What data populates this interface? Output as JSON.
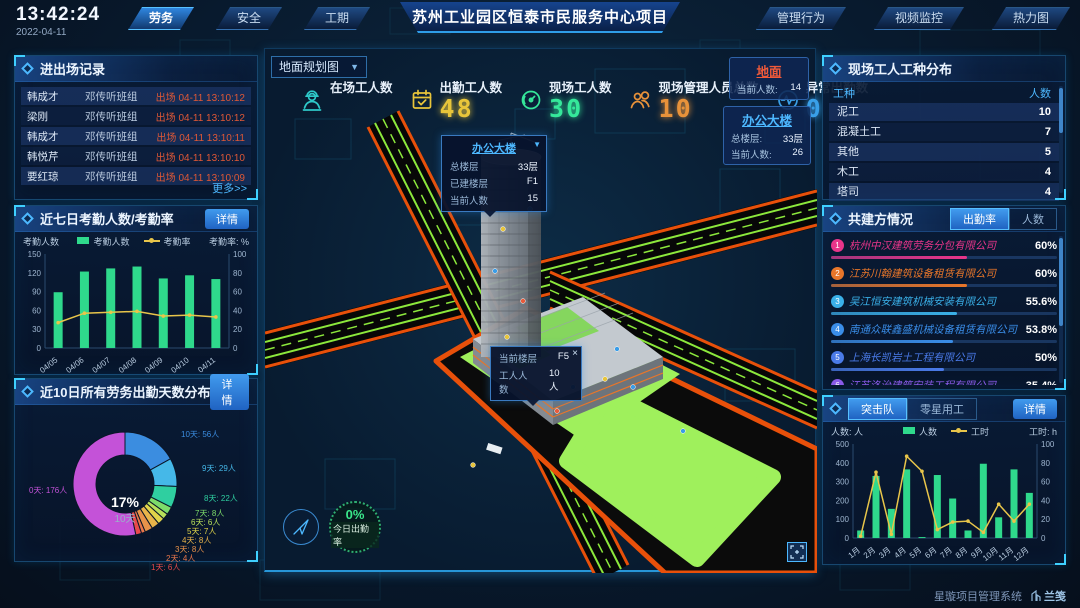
{
  "header": {
    "time": "13:42:24",
    "date": "2022-04-11",
    "left_tabs": [
      {
        "label": "劳务",
        "active": true
      },
      {
        "label": "安全",
        "active": false
      },
      {
        "label": "工期",
        "active": false
      }
    ],
    "title": "苏州工业园区恒泰市民服务中心项目",
    "right_tabs": [
      {
        "label": "管理行为",
        "active": false
      },
      {
        "label": "视频监控",
        "active": false
      },
      {
        "label": "热力图",
        "active": false
      }
    ]
  },
  "entry_exit_panel": {
    "title": "进出场记录",
    "more_label": "更多>>",
    "rows": [
      {
        "name": "韩成才",
        "group": "邓传听班组",
        "event": "出场 04-11 13:10:12"
      },
      {
        "name": "梁刚",
        "group": "邓传听班组",
        "event": "出场 04-11 13:10:12"
      },
      {
        "name": "韩成才",
        "group": "邓传听班组",
        "event": "出场 04-11 13:10:11"
      },
      {
        "name": "韩悦芹",
        "group": "邓传听班组",
        "event": "出场 04-11 13:10:10"
      },
      {
        "name": "要红琼",
        "group": "邓传听班组",
        "event": "出场 04-11 13:10:09"
      }
    ]
  },
  "attendance_panel": {
    "title": "近七日考勤人数/考勤率",
    "detail_label": "详情"
  },
  "distribution_panel": {
    "title": "近10日所有劳务出勤天数分布",
    "detail_label": "详情"
  },
  "map": {
    "view_select": "地面规划图",
    "stats": [
      {
        "label": "在场工人数",
        "value": "",
        "color": "#2ec8c8",
        "icon": "worker-icon"
      },
      {
        "label": "出勤工人数",
        "value": "48",
        "color": "#e8c53a",
        "icon": "calendar-check-icon"
      },
      {
        "label": "现场工人数",
        "value": "30",
        "color": "#35e89a",
        "icon": "gauge-icon"
      },
      {
        "label": "现场管理人员总数",
        "value": "10",
        "color": "#e8923a",
        "icon": "people-icon"
      },
      {
        "label": "异常出勤数",
        "value": "0",
        "color": "#3aa0e8",
        "icon": "pulse-icon"
      }
    ],
    "building_tooltip": {
      "title": "办公大楼",
      "rows": [
        [
          "总楼层",
          "33层"
        ],
        [
          "已建楼层",
          "F1"
        ],
        [
          "当前人数",
          "15"
        ]
      ]
    },
    "floor_tooltip": {
      "close": "×",
      "rows": [
        [
          "当前楼层",
          "F5"
        ],
        [
          "工人人数",
          "10人"
        ]
      ]
    },
    "side_cards": [
      {
        "title": "地面",
        "title_color": "#f05a3a",
        "rows": [
          [
            "当前人数:",
            "14"
          ]
        ]
      },
      {
        "title": "办公大楼",
        "title_color": "#4db8ff",
        "rows": [
          [
            "总楼层:",
            "33层"
          ],
          [
            "当前人数:",
            "26"
          ]
        ]
      }
    ],
    "gauge": {
      "value": "0%",
      "label": "今日出勤率"
    }
  },
  "worker_type_panel": {
    "title": "现场工人工种分布",
    "headers": [
      "工种",
      "人数"
    ],
    "rows": [
      [
        "泥工",
        "10"
      ],
      [
        "混凝土工",
        "7"
      ],
      [
        "其他",
        "5"
      ],
      [
        "木工",
        "4"
      ],
      [
        "塔司",
        "4"
      ]
    ]
  },
  "partners_panel": {
    "title": "共建方情况",
    "tabs": [
      {
        "label": "出勤率",
        "active": true
      },
      {
        "label": "人数",
        "active": false
      }
    ],
    "items": [
      {
        "rank": "1",
        "name": "杭州中汉建筑劳务分包有限公司",
        "value": "60%",
        "pct": 60,
        "color": "#e8358a"
      },
      {
        "rank": "2",
        "name": "江苏川翰建筑设备租赁有限公司",
        "value": "60%",
        "pct": 60,
        "color": "#e8762a"
      },
      {
        "rank": "3",
        "name": "吴江恒安建筑机械安装有限公司",
        "value": "55.6%",
        "pct": 55.6,
        "color": "#3ab0e8"
      },
      {
        "rank": "4",
        "name": "南通众联鑫盛机械设备租赁有限公司",
        "value": "53.8%",
        "pct": 53.8,
        "color": "#3a8de8"
      },
      {
        "rank": "5",
        "name": "上海长凯岩土工程有限公司",
        "value": "50%",
        "pct": 50,
        "color": "#4a7ae8"
      },
      {
        "rank": "6",
        "name": "江苏洛治建筑安装工程有限公司",
        "value": "35.4%",
        "pct": 35.4,
        "color": "#8a5ae8"
      }
    ]
  },
  "assault_panel": {
    "tabs": [
      {
        "label": "突击队",
        "active": true
      },
      {
        "label": "零星用工",
        "active": false
      }
    ],
    "detail_label": "详情"
  },
  "footer": {
    "system_name": "星璇项目管理系统",
    "brand": "兰笺"
  },
  "chart_data": [
    {
      "type": "bar+line",
      "title": "近七日考勤人数/考勤率",
      "categories": [
        "04/05",
        "04/06",
        "04/07",
        "04/08",
        "04/09",
        "04/10",
        "04/11"
      ],
      "series": [
        {
          "name": "考勤人数",
          "type": "bar",
          "axis": "left",
          "color": "#2fd98c",
          "values": [
            89,
            122,
            127,
            130,
            111,
            116,
            110
          ]
        },
        {
          "name": "考勤率",
          "type": "line",
          "axis": "right",
          "color": "#e8c54a",
          "values": [
            27,
            37,
            38,
            39,
            34,
            35,
            33
          ]
        }
      ],
      "ylabel_left": "考勤人数",
      "ylabel_right": "考勤率: %",
      "ylim_left": [
        0,
        150
      ],
      "ylim_right": [
        0,
        100
      ],
      "legend_position": "top",
      "grid": false
    },
    {
      "type": "pie",
      "title": "近10日所有劳务出勤天数分布",
      "labels": [
        "10天",
        "9天",
        "8天",
        "7天",
        "6天",
        "5天",
        "4天",
        "3天",
        "2天",
        "1天",
        "0天"
      ],
      "values": [
        56,
        29,
        22,
        8,
        6,
        7,
        8,
        8,
        4,
        6,
        176
      ],
      "unit": "人",
      "colors": [
        "#3b8de0",
        "#45b8e8",
        "#2fcfa0",
        "#7ddc6a",
        "#b8e05a",
        "#e0d44a",
        "#e8b44a",
        "#e8934a",
        "#e8764a",
        "#e84a4a",
        "#c452d8"
      ],
      "center": {
        "pct": "17%",
        "label": "10天"
      }
    },
    {
      "type": "bar+line",
      "title": "突击队",
      "categories": [
        "1月",
        "2月",
        "3月",
        "4月",
        "5月",
        "6月",
        "7月",
        "8月",
        "9月",
        "10月",
        "11月",
        "12月"
      ],
      "series": [
        {
          "name": "人数",
          "type": "bar",
          "axis": "left",
          "color": "#2fd98c",
          "values": [
            40,
            330,
            155,
            365,
            5,
            335,
            210,
            40,
            395,
            110,
            365,
            240
          ]
        },
        {
          "name": "工时",
          "type": "line",
          "axis": "right",
          "color": "#e8c54a",
          "values": [
            2,
            70,
            4,
            87,
            71,
            9,
            17,
            18,
            6,
            36,
            18,
            36
          ]
        }
      ],
      "ylabel_left": "人数: 人",
      "ylabel_right": "工时: h",
      "ylim_left": [
        0,
        500
      ],
      "ylim_right": [
        0,
        100
      ],
      "legend_position": "top",
      "grid": false
    }
  ]
}
